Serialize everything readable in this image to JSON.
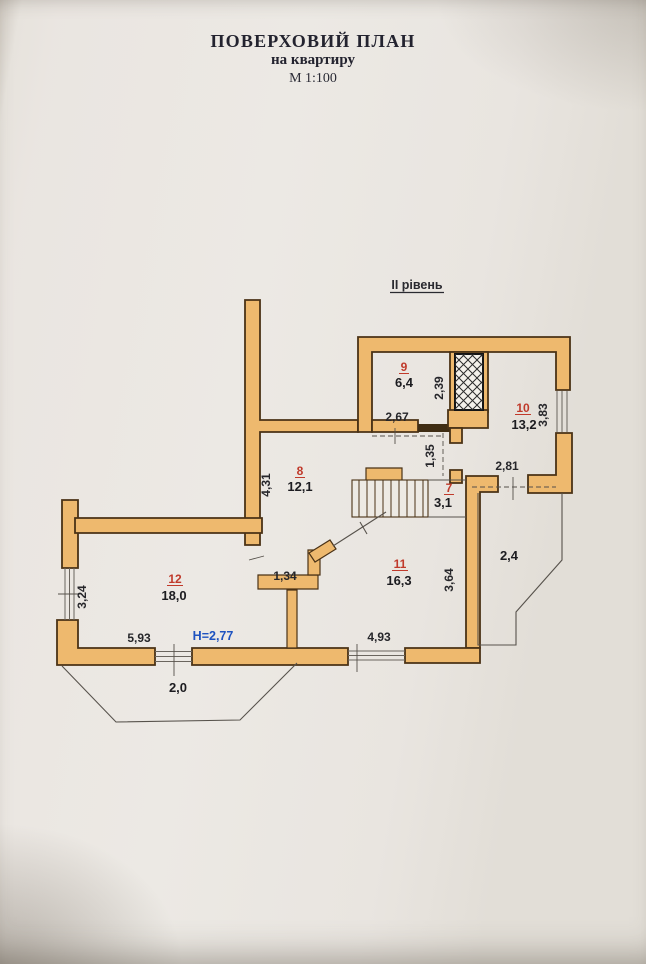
{
  "document": {
    "title": "ПОВЕРХОВИЙ ПЛАН",
    "subtitle": "на квартиру",
    "scale": "М 1:100",
    "level_label": "ІІ рівень"
  },
  "rooms": [
    {
      "number": "7",
      "area": "3,1"
    },
    {
      "number": "8",
      "area": "12,1"
    },
    {
      "number": "9",
      "area": "6,4"
    },
    {
      "number": "10",
      "area": "13,2"
    },
    {
      "number": "11",
      "area": "16,3"
    },
    {
      "number": "12",
      "area": "18,0"
    }
  ],
  "balconies": [
    {
      "label": "2,4"
    },
    {
      "label": "2,0"
    }
  ],
  "dimensions": [
    {
      "value": "2,39",
      "orientation": "vertical"
    },
    {
      "value": "2,67",
      "orientation": "horizontal"
    },
    {
      "value": "1,35",
      "orientation": "vertical"
    },
    {
      "value": "3,83",
      "orientation": "vertical"
    },
    {
      "value": "2,81",
      "orientation": "horizontal"
    },
    {
      "value": "4,31",
      "orientation": "vertical"
    },
    {
      "value": "1,34",
      "orientation": "horizontal"
    },
    {
      "value": "3,64",
      "orientation": "vertical"
    },
    {
      "value": "3,24",
      "orientation": "vertical"
    },
    {
      "value": "5,93",
      "orientation": "horizontal"
    },
    {
      "value": "4,93",
      "orientation": "horizontal"
    }
  ],
  "height_note": "Н=2,77",
  "colors": {
    "wall_fill": "#eeb96e",
    "wall_outline": "#4a3216",
    "room_number_red": "#c03a2b",
    "height_note_blue": "#1d52c0",
    "paper": "#eae6e1",
    "ink": "#23232f"
  }
}
